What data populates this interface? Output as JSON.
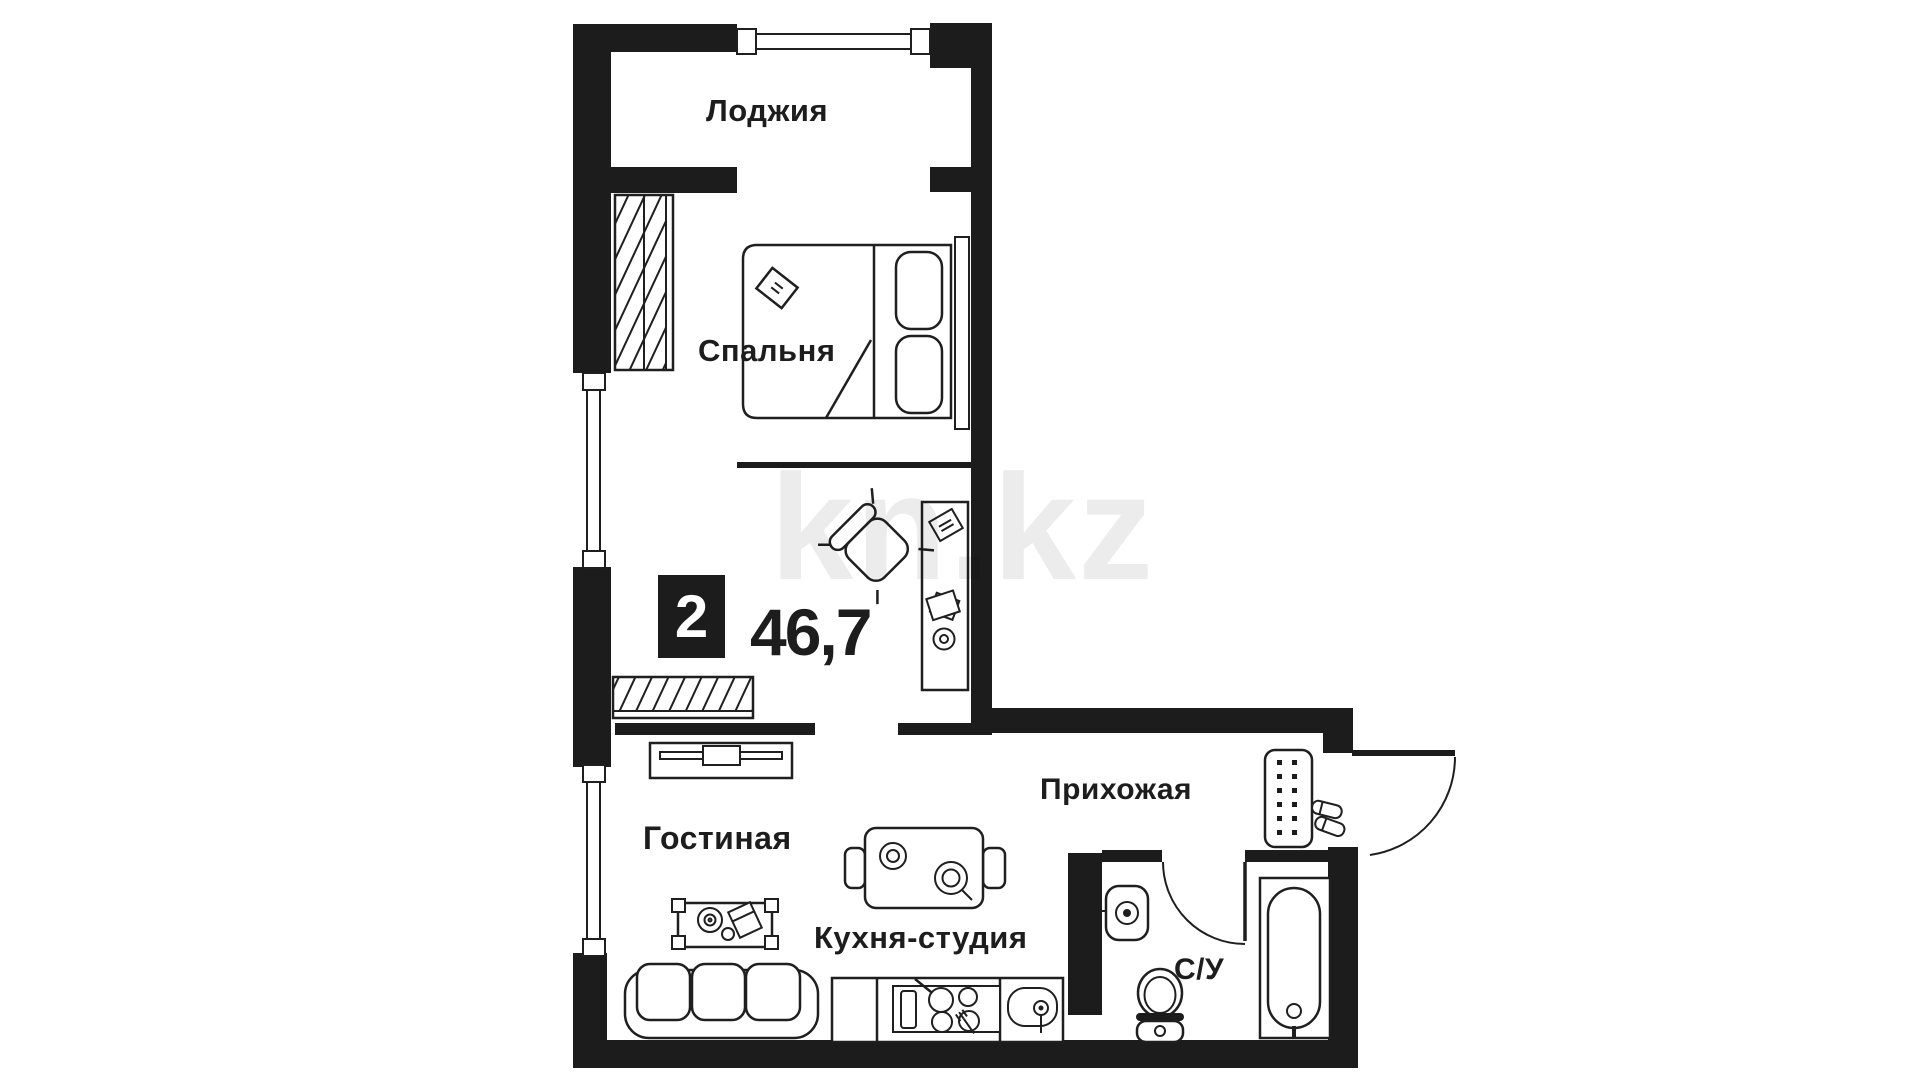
{
  "plan": {
    "badge": "2",
    "area": "46,7",
    "watermark": "kn.kz",
    "rooms": [
      {
        "id": "loggia",
        "label": "Лоджия"
      },
      {
        "id": "bedroom",
        "label": "Спальня"
      },
      {
        "id": "living",
        "label": "Гостиная"
      },
      {
        "id": "kitchen",
        "label": "Кухня-студия"
      },
      {
        "id": "hallway",
        "label": "Прихожая"
      },
      {
        "id": "bathroom",
        "label": "С/У"
      }
    ],
    "icons": [
      "wardrobe-hatch-icon",
      "double-bed-icon",
      "pillow-icon",
      "radiator-icon",
      "shelf-hatch-icon",
      "tv-stand-icon",
      "desk-icon",
      "armchair-icon",
      "coffee-table-icon",
      "sofa-icon",
      "dining-table-icon",
      "stove-icon",
      "kitchen-sink-icon",
      "shoe-cabinet-icon",
      "slippers-icon",
      "door-swing-icon",
      "washbasin-icon",
      "toilet-icon",
      "bathtub-icon",
      "window-icon"
    ],
    "colors": {
      "wall": "#1c1c1c",
      "line": "#1f1f1f",
      "text": "#1d1d1d",
      "watermark": "#ececec",
      "background": "#ffffff"
    }
  }
}
